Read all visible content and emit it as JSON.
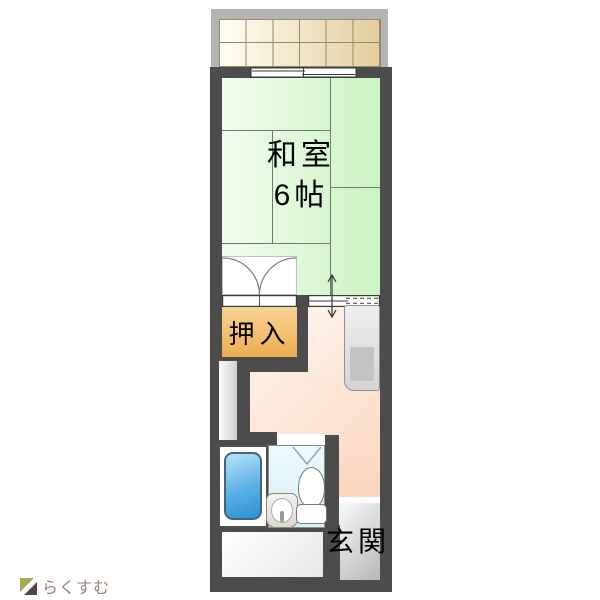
{
  "floorplan": {
    "rooms": {
      "washitsu": {
        "name": "和室",
        "size": "6帖"
      },
      "oshiire": {
        "label": "押入"
      },
      "genkan": {
        "label": "玄関"
      }
    },
    "colors": {
      "wall": "#4c4c4c",
      "tatami_green": "#cbf3c1",
      "closet_orange": "#eead50",
      "kitchen_pink": "#fcd5bf",
      "bathroom_blue": "#ddf2f7",
      "bathtub_blue": "#2f8fd2",
      "balcony_tile_tan": "#e4cd9c",
      "entrance_gray": "#b7b7b7"
    }
  },
  "branding": {
    "logo_text": "らくすむ",
    "logo_color": "#9b8374"
  }
}
